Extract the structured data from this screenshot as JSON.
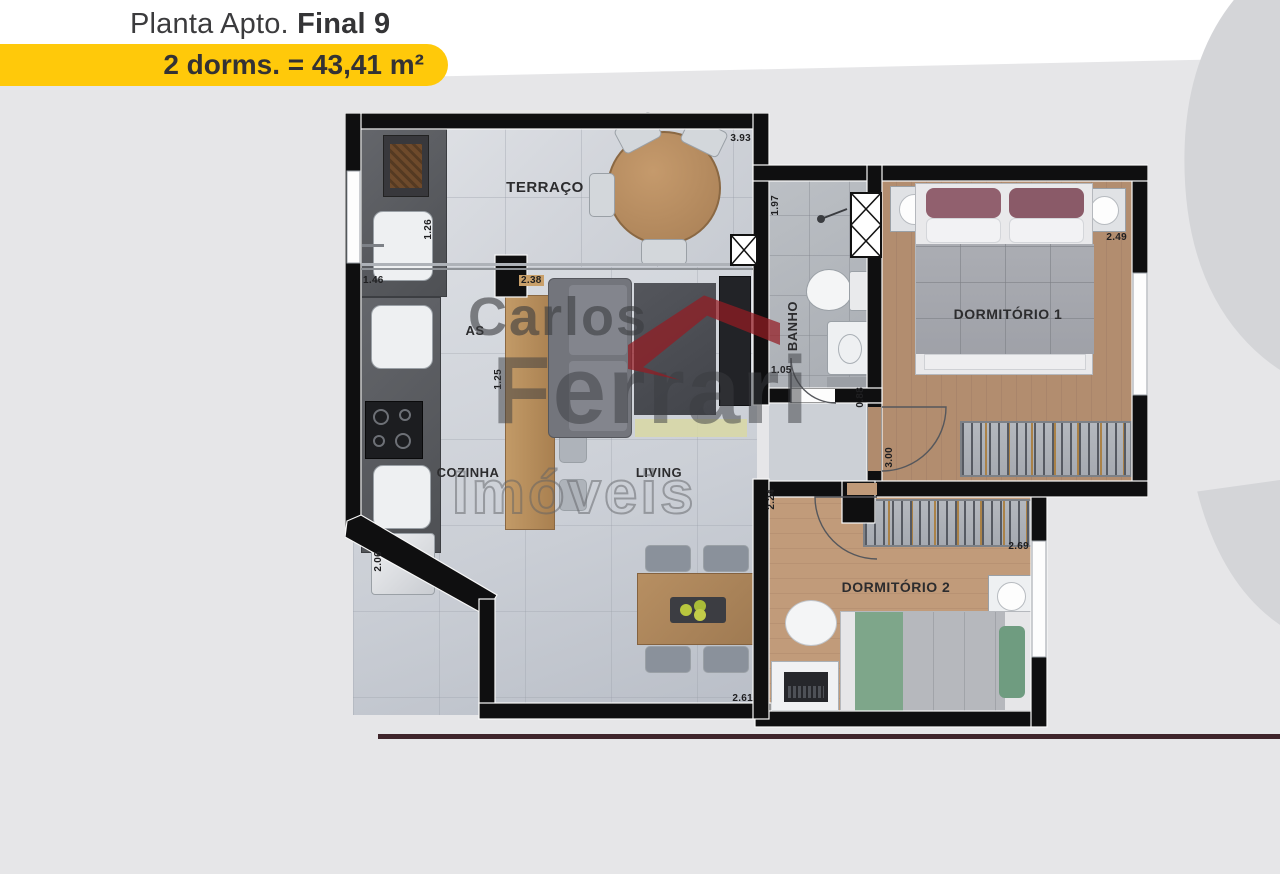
{
  "header": {
    "title_prefix": "Planta Apto. ",
    "title_emphasis": "Final 9",
    "badge": "2 dorms. = 43,41 m²",
    "badge_color": "#ffc90a",
    "title_color": "#3b3b3d"
  },
  "watermarks": {
    "brand_line1": "Carlos",
    "brand_line2": "Ferrari",
    "brand_line3": "Imóveis",
    "brand_logo_color": "#941c22",
    "corner_number": "9"
  },
  "plan": {
    "rooms": {
      "terraco": "TERRAÇO",
      "as": "AS",
      "banho": "BANHO",
      "dorm1": "DORMITÓRIO 1",
      "cozinha": "COZINHA",
      "living": "LIVING",
      "dorm2": "DORMITÓRIO 2"
    },
    "dims": {
      "terraco_width": "3.93",
      "terraco_counter": "1.26",
      "as_width": "1.46",
      "island_length": "2.38",
      "island_side": "1.25",
      "banho_length": "1.97",
      "banho_width": "1.05",
      "hall_width": "0.88",
      "dorm1_length": "3.00",
      "dorm1_width": "2.49",
      "cozinha_length": "2.06",
      "living_width": "2.61",
      "dorm2_side": "2.24",
      "dorm2_width": "2.69"
    },
    "wall_color": "#0f0f10",
    "accent_floor_wood": "#b08b6d"
  }
}
